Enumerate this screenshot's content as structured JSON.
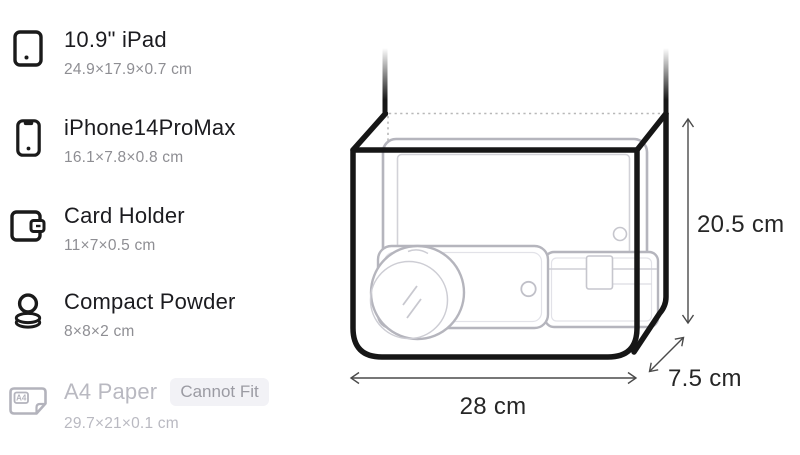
{
  "list": {
    "items": [
      {
        "title": "10.9\" iPad",
        "dims": "24.9×17.9×0.7 cm",
        "icon": "ipad"
      },
      {
        "title": "iPhone14ProMax",
        "dims": "16.1×7.8×0.8 cm",
        "icon": "iphone"
      },
      {
        "title": "Card Holder",
        "dims": "11×7×0.5 cm",
        "icon": "card-holder"
      },
      {
        "title": "Compact Powder",
        "dims": "8×8×2 cm",
        "icon": "compact-powder"
      },
      {
        "title": "A4 Paper",
        "dims": "29.7×21×0.1 cm",
        "icon": "a4-paper",
        "badge": "Cannot Fit"
      }
    ],
    "a4_icon_label": "A4"
  },
  "diagram": {
    "height_label": "20.5 cm",
    "width_label": "28 cm",
    "depth_label": "7.5 cm",
    "contents": [
      "iPad",
      "iPhone",
      "Card Holder",
      "Compact Powder"
    ]
  },
  "colors": {
    "title_text": "#1b1b1f",
    "subtitle_text": "#8e8e93",
    "disabled_text": "#b9b9c1",
    "badge_bg": "#f2f2f6",
    "badge_text": "#9b9ba3",
    "bag_outline": "#161616",
    "ghost_outline": "#b5b5bd",
    "dimension_text": "#262626"
  }
}
